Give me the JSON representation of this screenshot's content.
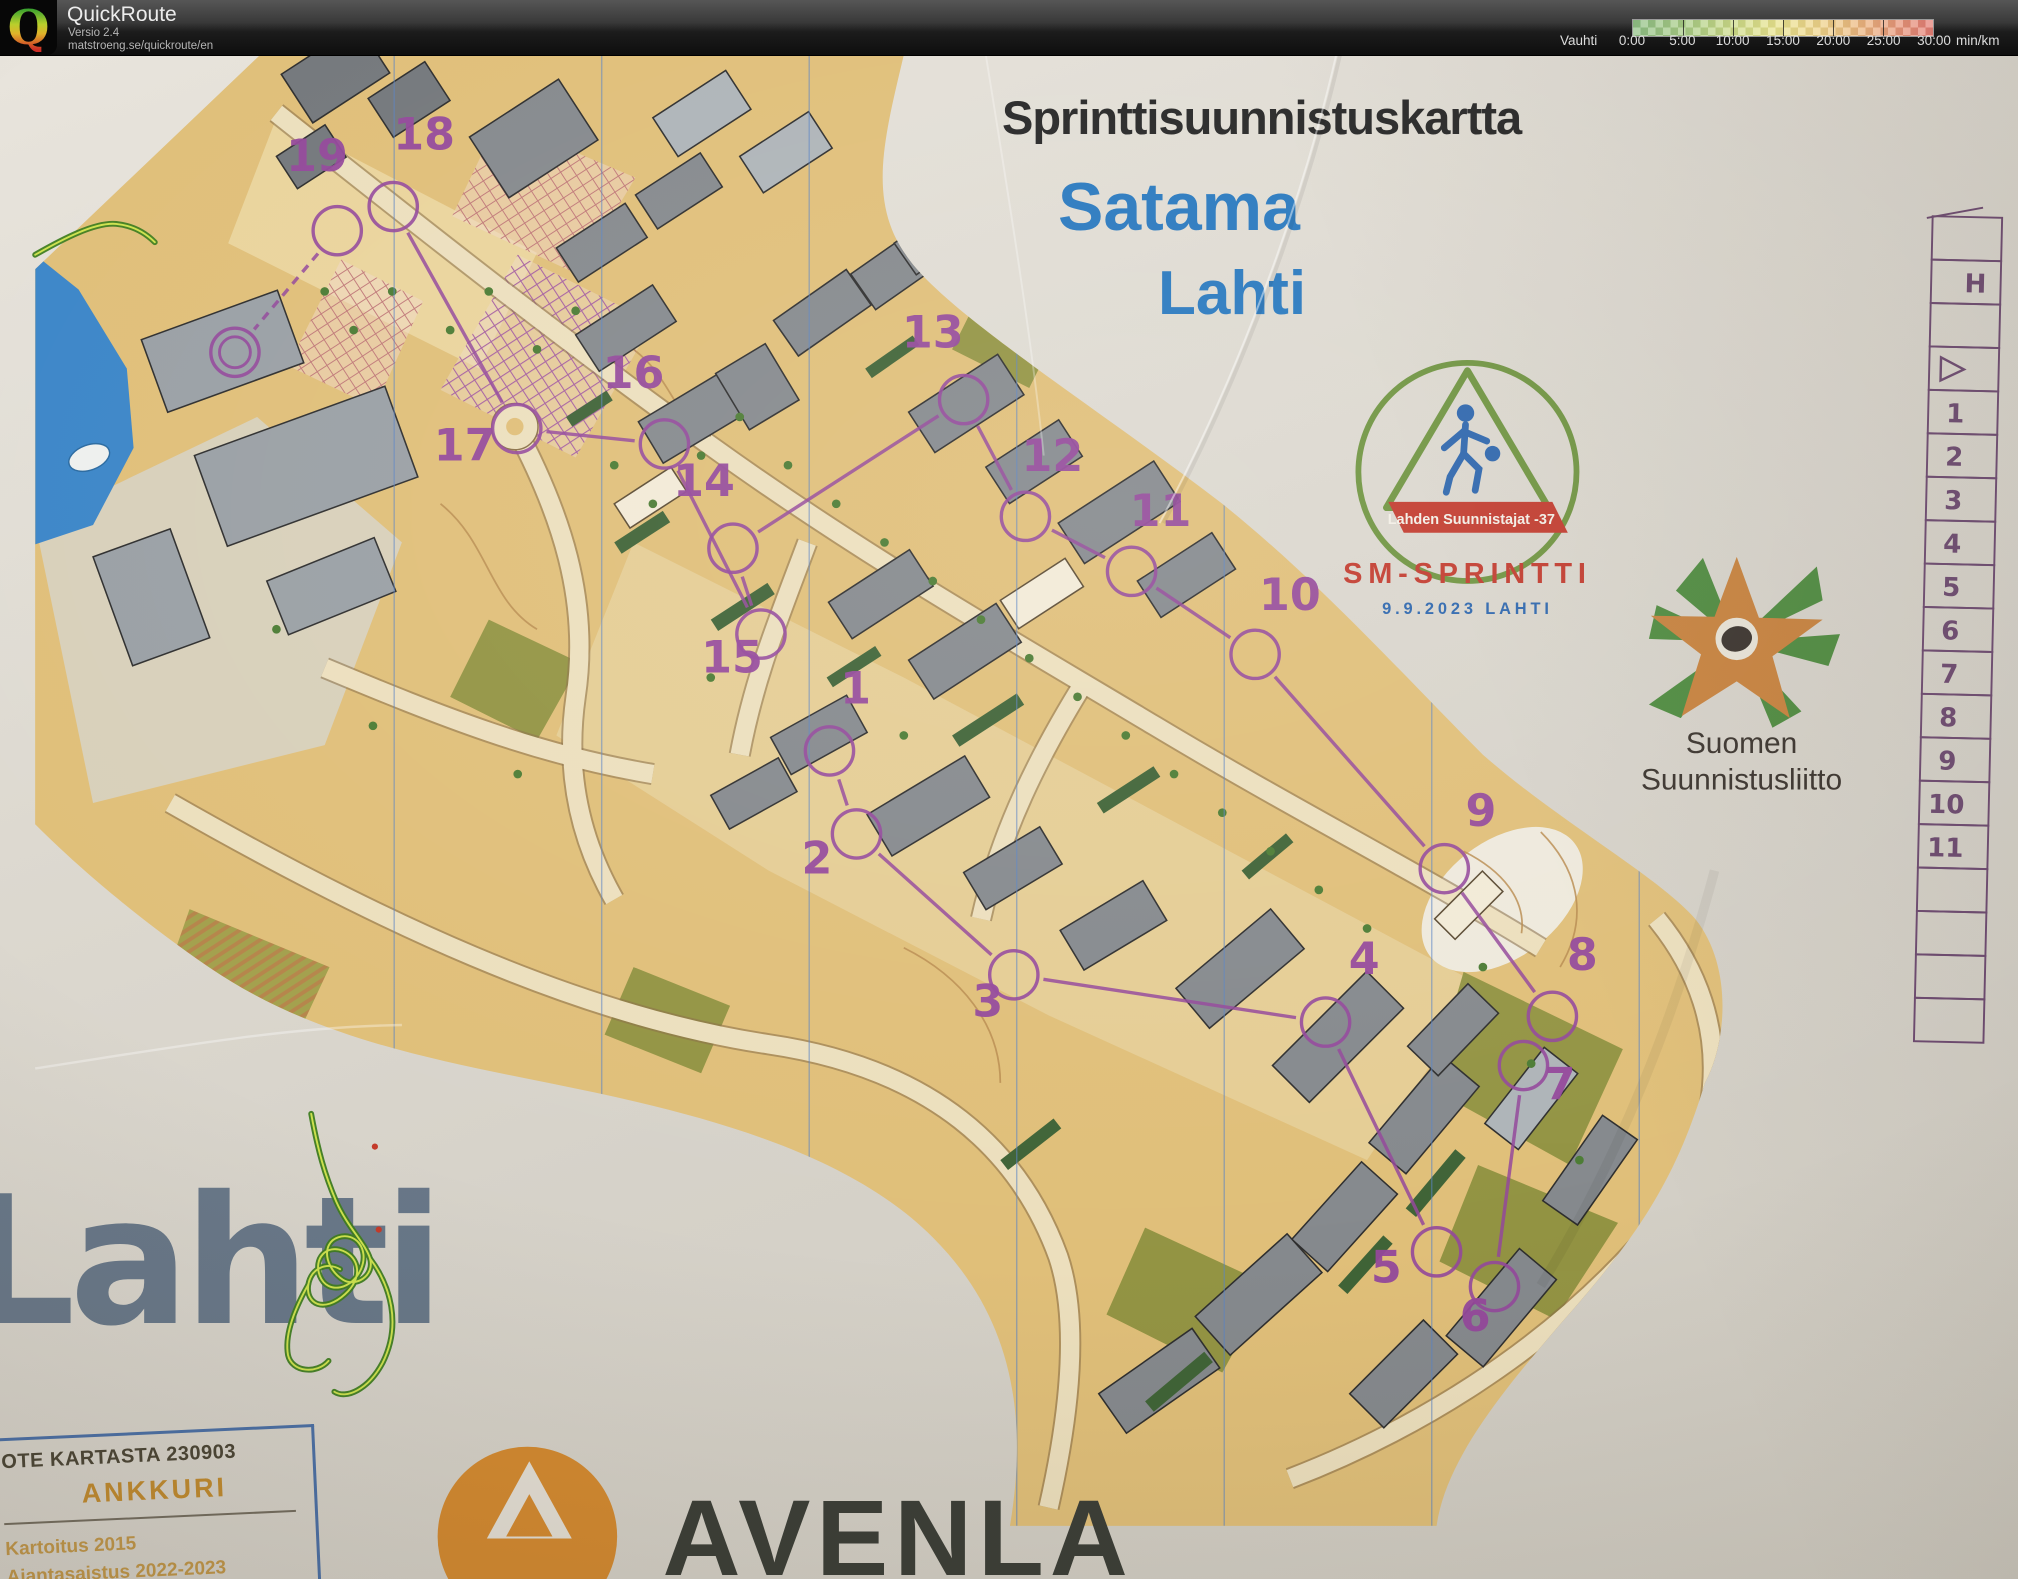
{
  "header": {
    "app_title": "QuickRoute",
    "version": "Versio 2.4",
    "url": "matstroeng.se/quickroute/en",
    "legend": {
      "label": "Vauhti",
      "unit": "min/km",
      "ticks": [
        "0:00",
        "5:00",
        "10:00",
        "15:00",
        "20:00",
        "25:00",
        "30:00"
      ],
      "gradient_colors": [
        "#8fbf85",
        "#ccdb88",
        "#e9e38d",
        "#ecb57e",
        "#e37d75"
      ]
    }
  },
  "map": {
    "title": "Sprinttisuunnistuskartta",
    "subtitle": "Satama",
    "city": "Lahti",
    "scale": "Mittakaava 1:4000",
    "contour_interval": "Käyräväli 2,5 m",
    "event_logo": {
      "club": "Lahden Suunnistajat",
      "club_suffix": "-37",
      "event": "SM-SPRINTTI",
      "date_place": "9.9.2023 LAHTI",
      "ring_color": "#6f9440",
      "red": "#c23b2e",
      "blue": "#2d66ad"
    },
    "federation_logo": {
      "line1": "Suomen",
      "line2": "Suunnistusliitto"
    },
    "brand": "Lahti",
    "sponsor": "AVENLA",
    "info_box": {
      "line1": "OTE KARTASTA 230903",
      "line2": "ANKKURI",
      "line3": "Kartoitus 2015",
      "line4": "Ajantasaistus 2022-2023"
    },
    "course": {
      "color": "#94489b",
      "controls": [
        {
          "n": "1",
          "num": [
            850,
            727
          ],
          "circle": [
            823,
            776
          ]
        },
        {
          "n": "2",
          "num": [
            810,
            903
          ],
          "circle": [
            851,
            862
          ]
        },
        {
          "n": "3",
          "num": [
            987,
            1051
          ],
          "circle": [
            1014,
            1008
          ]
        },
        {
          "n": "4",
          "num": [
            1377,
            1007
          ],
          "circle": [
            1337,
            1057
          ]
        },
        {
          "n": "5",
          "num": [
            1400,
            1327
          ],
          "circle": [
            1452,
            1295
          ]
        },
        {
          "n": "6",
          "num": [
            1492,
            1377
          ],
          "circle": [
            1512,
            1331
          ]
        },
        {
          "n": "7",
          "num": [
            1580,
            1137
          ],
          "circle": [
            1542,
            1102
          ]
        },
        {
          "n": "8",
          "num": [
            1603,
            1003
          ],
          "circle": [
            1572,
            1051
          ]
        },
        {
          "n": "9",
          "num": [
            1498,
            854
          ],
          "circle": [
            1460,
            898
          ]
        },
        {
          "n": "10",
          "num": [
            1300,
            630
          ],
          "circle": [
            1264,
            676
          ]
        },
        {
          "n": "11",
          "num": [
            1166,
            543
          ],
          "circle": [
            1136,
            590
          ]
        },
        {
          "n": "12",
          "num": [
            1054,
            486
          ],
          "circle": [
            1026,
            533
          ]
        },
        {
          "n": "13",
          "num": [
            930,
            358
          ],
          "circle": [
            962,
            412
          ]
        },
        {
          "n": "14",
          "num": [
            693,
            512
          ],
          "circle": [
            723,
            566
          ]
        },
        {
          "n": "15",
          "num": [
            722,
            695
          ],
          "circle": [
            752,
            655
          ]
        },
        {
          "n": "16",
          "num": [
            620,
            400
          ],
          "circle": [
            652,
            458
          ]
        },
        {
          "n": "17",
          "num": [
            445,
            475
          ],
          "circle": [
            499,
            442
          ]
        },
        {
          "n": "18",
          "num": [
            403,
            153
          ],
          "circle": [
            371,
            212
          ]
        },
        {
          "n": "19",
          "num": [
            292,
            175
          ],
          "circle": [
            313,
            237
          ]
        }
      ],
      "finish": [
        207,
        363
      ]
    },
    "control_sheet": {
      "color": "#6d4a70",
      "rows": [
        "",
        "H",
        "",
        "start",
        "1",
        "2",
        "3",
        "4",
        "5",
        "6",
        "7",
        "8",
        "9",
        "10",
        "11",
        "",
        "",
        "",
        ""
      ]
    }
  }
}
